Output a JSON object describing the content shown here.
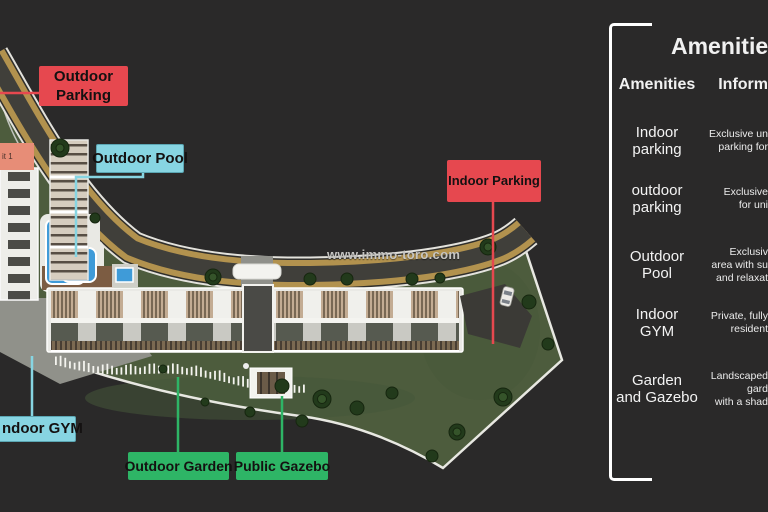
{
  "site": {
    "watermark": "www.immo-toro.com",
    "unit_label": "it 1"
  },
  "map_labels": {
    "outdoor_parking": "Outdoor Parking",
    "outdoor_pool": "Outdoor Pool",
    "indoor_parking": "Indoor Parking",
    "indoor_gym": "ndoor GYM",
    "outdoor_garden": "Outdoor Garden",
    "public_gazebo": "Public Gazebo"
  },
  "panel": {
    "title": "Amenities",
    "columns": {
      "amenities": "Amenities",
      "information": "Inform"
    },
    "rows": [
      {
        "name_lines": [
          "Indoor",
          "parking"
        ],
        "info_lines": [
          "Exclusive un",
          "parking for",
          ""
        ]
      },
      {
        "name_lines": [
          "outdoor",
          "parking"
        ],
        "info_lines": [
          "Exclusive",
          "for uni",
          ""
        ]
      },
      {
        "name_lines": [
          "Outdoor",
          "Pool"
        ],
        "info_lines": [
          "Exclusiv",
          "area with su",
          "and relaxat"
        ]
      },
      {
        "name_lines": [
          "Indoor",
          "GYM"
        ],
        "info_lines": [
          "Private, fully",
          "resident",
          ""
        ]
      },
      {
        "name_lines": [
          "Garden",
          "and Gazebo"
        ],
        "info_lines": [
          "Landscaped",
          "gard",
          "with a shad"
        ]
      }
    ]
  },
  "colors": {
    "red": "#e6484f",
    "cyan": "#87d5e2",
    "green": "#2eb566",
    "background": "#2a2929",
    "road_gold": "#b2924e",
    "grass": "#4d5c3d",
    "pool_blue": "#3f9bd8"
  }
}
